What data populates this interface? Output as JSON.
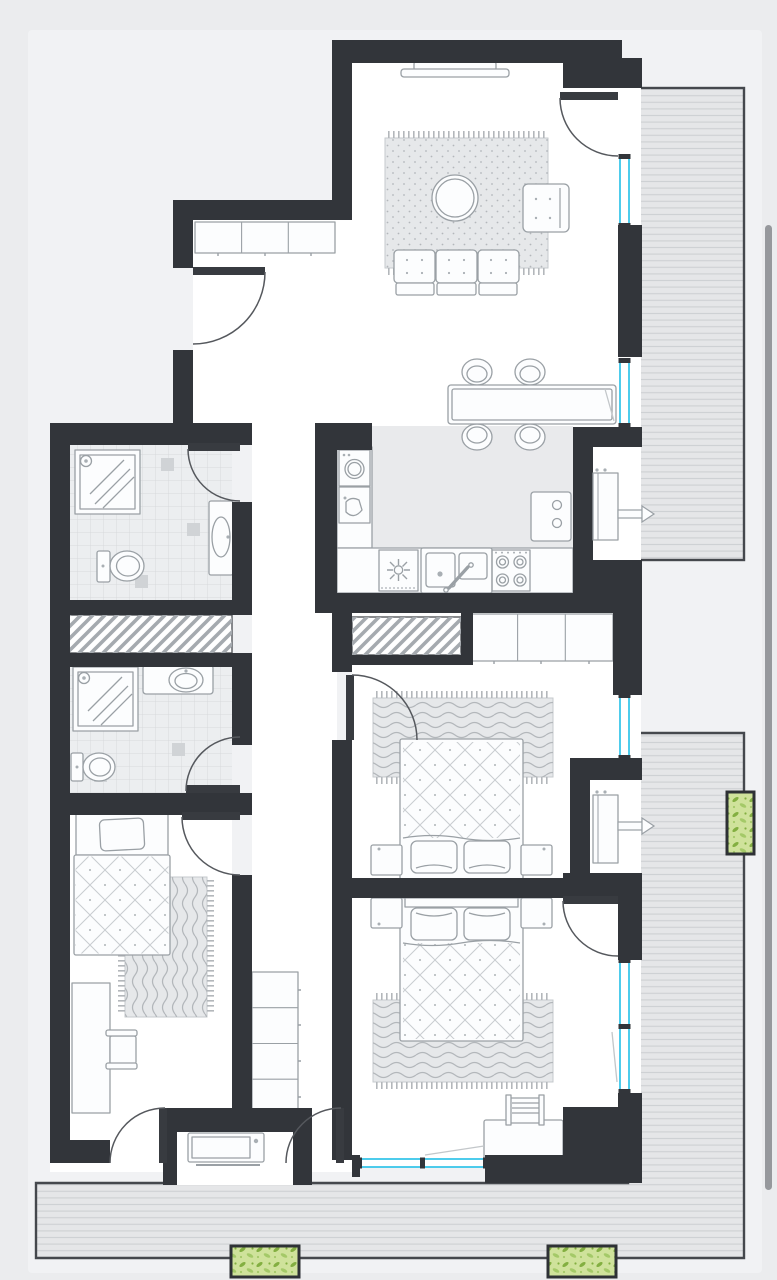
{
  "page": {
    "kind": "apartment-floor-plan-viewer",
    "text_labels": []
  },
  "colors": {
    "bg": "#ebecee",
    "halo": "#f1f2f4",
    "wall": "#32353a",
    "floor": "#ffffff",
    "floor-gray": "#e9eaec",
    "tile-base": "#eceef0",
    "tile-line": "#d7d9dc",
    "tile-accent": "#d0d3d6",
    "deck": "#e5e6e8",
    "deck-line": "#cdd0d3",
    "deck-border": "#45484d",
    "stroke": "#9aa0a5",
    "furn-fill": "#fcfdfe",
    "rug-base": "#e6e8ea",
    "rug-line": "#b3b7bb",
    "quilt-line": "#c8ccd0",
    "window": "#2fc3e9",
    "door": "#55585d",
    "door-leaf": "#383b40",
    "hatch-line": "#a5aaaf",
    "planter-border": "#2e3135",
    "planter-bg": "#cfe29b",
    "leaf-dark": "#83af41",
    "leaf-light": "#a4c968",
    "scrollbar": "#96989c"
  },
  "legend": {
    "rooms": [
      {
        "name": "living-dining-room",
        "symbols": [
          "tv-console",
          "area-rug",
          "coffee-table",
          "armchair",
          "sofa",
          "dining-table",
          "dining-chairs"
        ]
      },
      {
        "name": "kitchen",
        "symbols": [
          "washing-machine",
          "prep-sink",
          "oven",
          "double-sink",
          "cooktop",
          "fridge",
          "counters"
        ]
      },
      {
        "name": "bathroom-top",
        "symbols": [
          "shower",
          "toilet",
          "washbasin",
          "floor-tiles"
        ]
      },
      {
        "name": "bathroom-middle",
        "symbols": [
          "shower",
          "washbasin",
          "toilet",
          "floor-tiles"
        ]
      },
      {
        "name": "bedroom-single",
        "symbols": [
          "single-bed",
          "rug",
          "desk",
          "chair"
        ]
      },
      {
        "name": "bedroom-double-1",
        "symbols": [
          "double-bed",
          "nightstands",
          "rug",
          "wardrobe",
          "utility-shaft"
        ]
      },
      {
        "name": "bedroom-double-2",
        "symbols": [
          "double-bed",
          "nightstands",
          "rug",
          "desk",
          "chair"
        ]
      },
      {
        "name": "hallway",
        "symbols": [
          "entry-cabinets",
          "wardrobe",
          "entry-door"
        ]
      },
      {
        "name": "balcony-right-top",
        "symbols": [
          "decking",
          "ac-unit"
        ]
      },
      {
        "name": "balcony-right-bottom",
        "symbols": [
          "decking",
          "ac-unit",
          "planter"
        ]
      },
      {
        "name": "terrace-bottom",
        "symbols": [
          "decking",
          "storage-unit",
          "planters"
        ]
      }
    ],
    "window_count": 5,
    "planter_count": 3,
    "shaft_count": 2
  }
}
